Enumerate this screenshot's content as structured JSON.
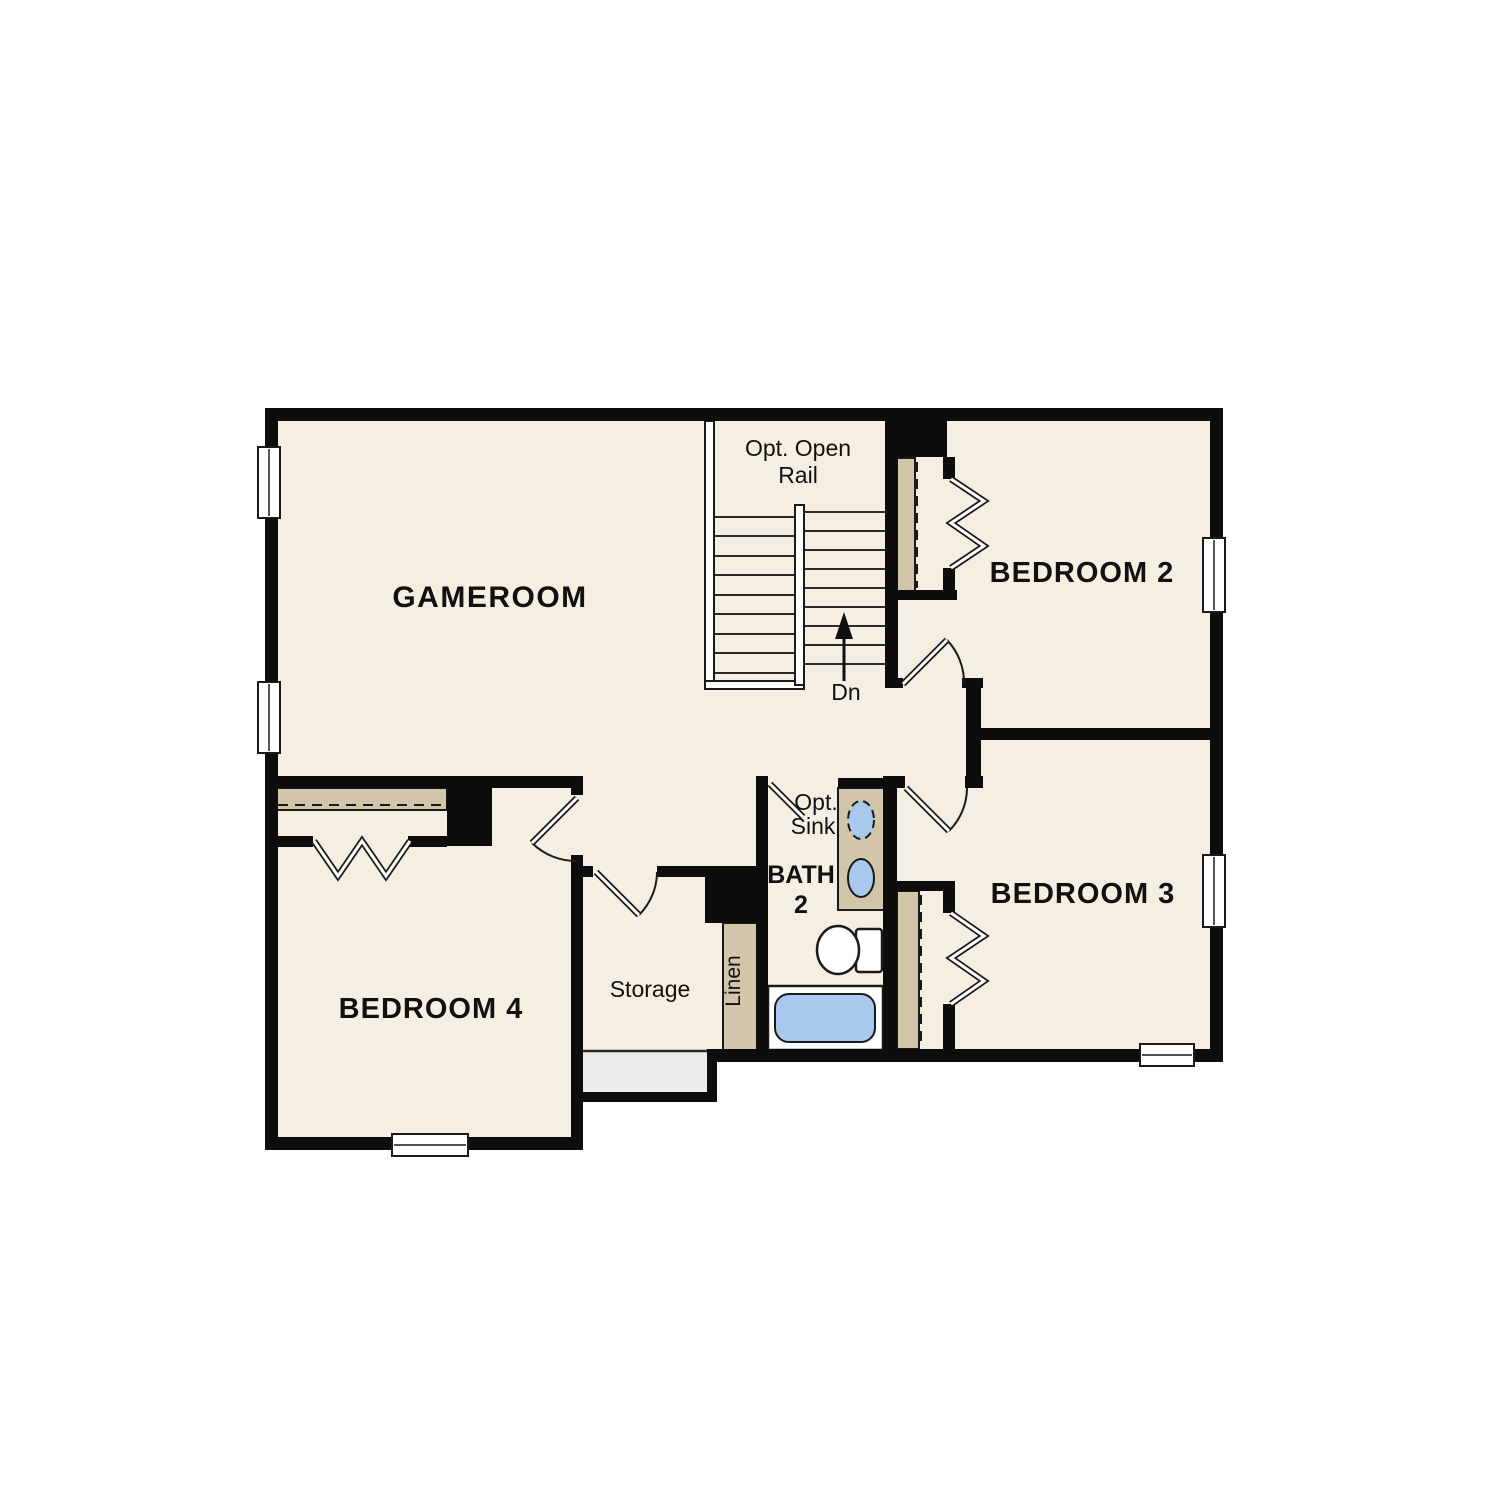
{
  "floorplan": {
    "rooms": {
      "gameroom": {
        "label": "GAMEROOM"
      },
      "bedroom2": {
        "label": "BEDROOM 2"
      },
      "bedroom3": {
        "label": "BEDROOM 3"
      },
      "bedroom4": {
        "label": "BEDROOM 4"
      },
      "bath2": {
        "label_line1": "BATH",
        "label_line2": "2"
      },
      "storage": {
        "label": "Storage"
      },
      "linen": {
        "label": "Linen"
      }
    },
    "stairs": {
      "note_line1": "Opt. Open",
      "note_line2": "Rail",
      "down_label": "Dn"
    },
    "bath_annotations": {
      "opt_sink_line1": "Opt.",
      "opt_sink_line2": "Sink"
    },
    "colors": {
      "floor": "#f5eee3",
      "wall": "#0d0d0d",
      "shelf_tan": "#d3c5a9",
      "fixture_blue": "#a9c9ec",
      "landing_gray": "#ececec",
      "label_text": "#111111"
    }
  }
}
